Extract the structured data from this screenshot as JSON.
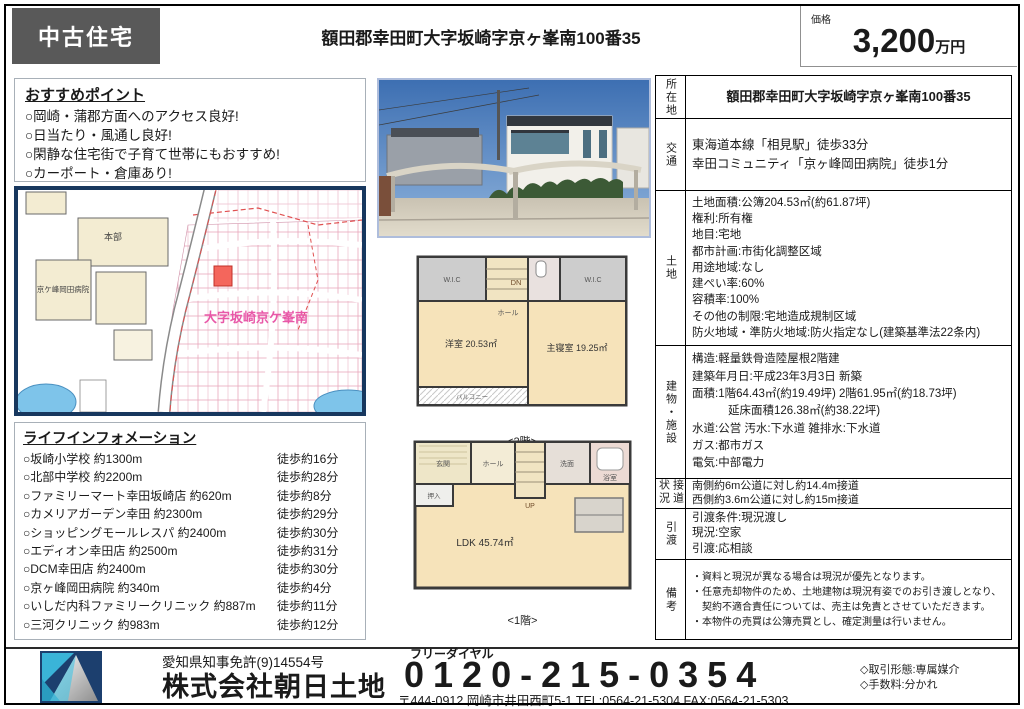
{
  "header": {
    "badge": "中古住宅",
    "title": "額田郡幸田町大字坂崎字京ヶ峯南100番35",
    "price_label": "価格",
    "price_value": "3,200",
    "price_unit": "万円"
  },
  "recommend": {
    "title": "おすすめポイント",
    "items": [
      "○岡崎・蒲郡方面へのアクセス良好!",
      "○日当たり・風通し良好!",
      "○閑静な住宅街で子育て世帯にもおすすめ!",
      "○カーポート・倉庫あり!"
    ]
  },
  "map": {
    "facility1": "本部",
    "facility2": "京ケ峰岡田病院",
    "area_label": "大字坂崎京ケ峯南",
    "highlight_color": "#f4665c",
    "border_color": "#17375e"
  },
  "floorplan2f": {
    "wic_left": "W.I.C",
    "wic_right": "W.I.C",
    "dn": "DN",
    "hall": "ホール",
    "room_left": "洋室 20.53㎡",
    "room_right": "主寝室 19.25㎡",
    "balcony": "バルコニー",
    "caption": "<2階>"
  },
  "floorplan1f": {
    "genkan": "玄関",
    "hall": "ホール",
    "up": "UP",
    "washroom": "洗面",
    "bath": "浴室",
    "closet": "押入",
    "ldk": "LDK 45.74㎡",
    "caption": "<1階>"
  },
  "lifeinfo": {
    "title": "ライフインフォメーション",
    "items": [
      {
        "name": "○坂崎小学校 約1300m",
        "walk": "徒歩約16分"
      },
      {
        "name": "○北部中学校 約2200m",
        "walk": "徒歩約28分"
      },
      {
        "name": "○ファミリーマート幸田坂崎店 約620m",
        "walk": "徒歩約8分"
      },
      {
        "name": "○カメリアガーデン幸田 約2300m",
        "walk": "徒歩約29分"
      },
      {
        "name": "○ショッピングモールレスパ 約2400m",
        "walk": "徒歩約30分"
      },
      {
        "name": "○エディオン幸田店 約2500m",
        "walk": "徒歩約31分"
      },
      {
        "name": "○DCM幸田店 約2400m",
        "walk": "徒歩約30分"
      },
      {
        "name": "○京ヶ峰岡田病院 約340m",
        "walk": "徒歩約4分"
      },
      {
        "name": "○いしだ内科ファミリークリニック 約887m",
        "walk": "徒歩約11分"
      },
      {
        "name": "○三河クリニック 約983m",
        "walk": "徒歩約12分"
      }
    ]
  },
  "details": {
    "rows": [
      {
        "label": "所在地",
        "lines": [
          "額田郡幸田町大字坂崎字京ヶ峯南100番35"
        ]
      },
      {
        "label": "交通",
        "lines": [
          "東海道本線「相見駅」徒歩33分",
          "幸田コミュニティ「京ヶ峰岡田病院」徒歩1分"
        ]
      },
      {
        "label": "土地",
        "lines": [
          "土地面積:公簿204.53㎡(約61.87坪)",
          "権利:所有権",
          "地目:宅地",
          "都市計画:市街化調整区域",
          "用途地域:なし",
          "建ぺい率:60%",
          "容積率:100%",
          "その他の制限:宅地造成規制区域",
          "防火地域・準防火地域:防火指定なし(建築基準法22条内)"
        ]
      },
      {
        "label": "建物・施設",
        "lines": [
          "構造:軽量鉄骨造陸屋根2階建",
          "建築年月日:平成23年3月3日 新築",
          "面積:1階64.43㎡(約19.49坪) 2階61.95㎡(約18.73坪)",
          "延床面積126.38㎡(約38.22坪)",
          "水道:公営 汚水:下水道 雑排水:下水道",
          "ガス:都市ガス",
          "電気:中部電力"
        ]
      },
      {
        "label": "接道状況",
        "lines": [
          "南側約6m公道に対し約14.4m接道",
          "西側約3.6m公道に対し約15m接道"
        ]
      },
      {
        "label": "引渡",
        "lines": [
          "引渡条件:現況渡し",
          "現況:空家",
          "引渡:応相談"
        ]
      },
      {
        "label": "備考",
        "lines": [
          "・資料と現況が異なる場合は現況が優先となります。",
          "・任意売却物件のため、土地建物は現況有姿でのお引き渡しとなり、",
          "契約不適合責任については、売主は免責とさせていただきます。",
          "・本物件の売買は公簿売買とし、確定測量は行いません。"
        ]
      }
    ]
  },
  "footer": {
    "license": "愛知県知事免許(9)14554号",
    "company": "株式会社朝日土地",
    "freedial_label": "フリーダイヤル",
    "phone": "0120-215-0354",
    "address": "〒444-0912 岡崎市井田西町5-1 TEL:0564-21-5304 FAX:0564-21-5303",
    "note1": "◇取引形態:専属媒介",
    "note2": "◇手数料:分かれ"
  }
}
